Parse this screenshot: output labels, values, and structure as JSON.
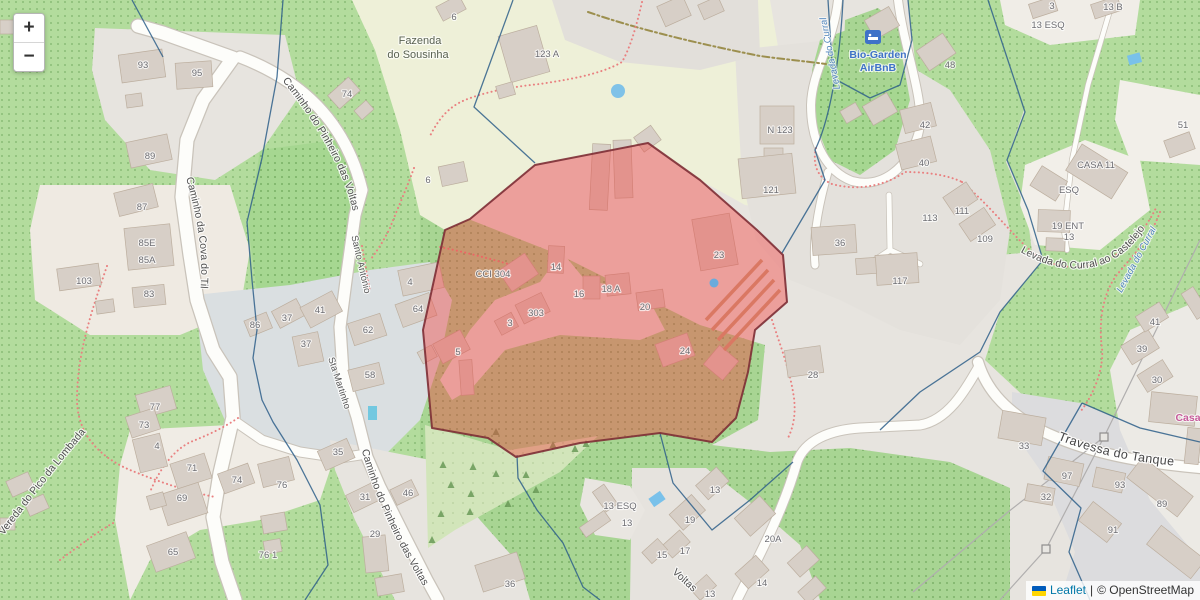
{
  "window": {
    "zoom_in": "+",
    "zoom_out": "−"
  },
  "attribution": {
    "flag": "ukraine-flag",
    "leaflet_link": "Leaflet",
    "separator": "|",
    "osm_text": "© OpenStreetMap"
  },
  "map": {
    "highlight": {
      "fill": "#f4413f",
      "fill_opacity": "0.42",
      "stroke": "#7d2d35"
    },
    "colors": {
      "forest_green": "#b3dc9d",
      "farmland": "#eef0d8",
      "residential": "#e4e1dc",
      "water": "#79c1ea",
      "boundary_blue": "#2e5f8a",
      "path_red": "#e98080"
    },
    "street_labels": [
      {
        "id": "p-pinheiro-top",
        "label": "Caminho do Pinheiro das Voltas",
        "cls": "street"
      },
      {
        "id": "p-cova",
        "label": "Caminho da Cova do Til",
        "cls": "street"
      },
      {
        "id": "p-vereda",
        "label": "Vereda do Pico da Lombada",
        "cls": "street"
      },
      {
        "id": "p-santo-antonio",
        "label": "Santo António",
        "cls": "street-small"
      },
      {
        "id": "p-sta-martinho",
        "label": "Sta Martinho",
        "cls": "street-small"
      },
      {
        "id": "p-pinheiro-bottom",
        "label": "Caminho do Pinheiro das Voltas",
        "cls": "street"
      },
      {
        "id": "p-voltas-frag",
        "label": "Voltas",
        "cls": "street"
      },
      {
        "id": "p-travessa",
        "label": "Travessa do Tanque",
        "cls": "street-big"
      },
      {
        "id": "p-levada-castelejo",
        "label": "Levada do Curral ao Castelejo",
        "cls": "street"
      },
      {
        "id": "p-levada-top",
        "label": "Levada do Curral",
        "cls": "water"
      },
      {
        "id": "p-levada-right",
        "label": "Levada do Curral",
        "cls": "water"
      }
    ],
    "place_labels": [
      {
        "label": "Fazenda",
        "x": 420,
        "y": 44,
        "cls": "place"
      },
      {
        "label": "do Sousinha",
        "x": 418,
        "y": 58,
        "cls": "place"
      },
      {
        "label": "Bio-Garden",
        "x": 878,
        "y": 58,
        "cls": "poi-lodging"
      },
      {
        "label": "AirBnB",
        "x": 878,
        "y": 71,
        "cls": "poi-lodging"
      },
      {
        "label": "Casa",
        "x": 1188,
        "y": 421,
        "cls": "poi-tourism"
      }
    ],
    "house_numbers": [
      {
        "t": "93",
        "x": 143,
        "y": 68
      },
      {
        "t": "95",
        "x": 197,
        "y": 76
      },
      {
        "t": "74",
        "x": 347,
        "y": 97
      },
      {
        "t": "89",
        "x": 150,
        "y": 159
      },
      {
        "t": "87",
        "x": 142,
        "y": 210
      },
      {
        "t": "85E",
        "x": 147,
        "y": 246
      },
      {
        "t": "85A",
        "x": 147,
        "y": 263
      },
      {
        "t": "103",
        "x": 84,
        "y": 284
      },
      {
        "t": "83",
        "x": 149,
        "y": 297
      },
      {
        "t": "86",
        "x": 255,
        "y": 328
      },
      {
        "t": "37",
        "x": 287,
        "y": 321
      },
      {
        "t": "41",
        "x": 320,
        "y": 313
      },
      {
        "t": "37",
        "x": 306,
        "y": 347
      },
      {
        "t": "62",
        "x": 368,
        "y": 333
      },
      {
        "t": "58",
        "x": 370,
        "y": 378
      },
      {
        "t": "64",
        "x": 418,
        "y": 312
      },
      {
        "t": "4",
        "x": 410,
        "y": 285
      },
      {
        "t": "6",
        "x": 454,
        "y": 20
      },
      {
        "t": "123 A",
        "x": 547,
        "y": 57
      },
      {
        "t": "6",
        "x": 428,
        "y": 183
      },
      {
        "t": "N 123",
        "x": 780,
        "y": 133
      },
      {
        "t": "121",
        "x": 771,
        "y": 193
      },
      {
        "t": "48",
        "x": 950,
        "y": 68
      },
      {
        "t": "42",
        "x": 925,
        "y": 128
      },
      {
        "t": "40",
        "x": 924,
        "y": 166
      },
      {
        "t": "36",
        "x": 840,
        "y": 246
      },
      {
        "t": "113",
        "x": 930,
        "y": 221
      },
      {
        "t": "111",
        "x": 962,
        "y": 214
      },
      {
        "t": "109",
        "x": 985,
        "y": 242
      },
      {
        "t": "117",
        "x": 900,
        "y": 284
      },
      {
        "t": "28",
        "x": 813,
        "y": 378
      },
      {
        "t": "3",
        "x": 1052,
        "y": 9
      },
      {
        "t": "13 B",
        "x": 1113,
        "y": 10
      },
      {
        "t": "13 ESQ",
        "x": 1048,
        "y": 28
      },
      {
        "t": "51",
        "x": 1183,
        "y": 128
      },
      {
        "t": "CASA 11",
        "x": 1096,
        "y": 168
      },
      {
        "t": "ESQ",
        "x": 1069,
        "y": 193
      },
      {
        "t": "19 ENT",
        "x": 1068,
        "y": 229
      },
      {
        "t": "13",
        "x": 1069,
        "y": 240
      },
      {
        "t": "41",
        "x": 1155,
        "y": 325
      },
      {
        "t": "39",
        "x": 1142,
        "y": 352
      },
      {
        "t": "30",
        "x": 1157,
        "y": 383
      },
      {
        "t": "33",
        "x": 1024,
        "y": 449
      },
      {
        "t": "97",
        "x": 1067,
        "y": 479
      },
      {
        "t": "93",
        "x": 1120,
        "y": 488
      },
      {
        "t": "89",
        "x": 1162,
        "y": 507
      },
      {
        "t": "91",
        "x": 1113,
        "y": 533
      },
      {
        "t": "32",
        "x": 1046,
        "y": 500
      },
      {
        "t": "77",
        "x": 155,
        "y": 410
      },
      {
        "t": "73",
        "x": 144,
        "y": 428
      },
      {
        "t": "4",
        "x": 157,
        "y": 449
      },
      {
        "t": "71",
        "x": 192,
        "y": 471
      },
      {
        "t": "69",
        "x": 182,
        "y": 501
      },
      {
        "t": "65",
        "x": 173,
        "y": 555
      },
      {
        "t": "74",
        "x": 237,
        "y": 483
      },
      {
        "t": "76",
        "x": 282,
        "y": 488
      },
      {
        "t": "76 1",
        "x": 268,
        "y": 558
      },
      {
        "t": "35",
        "x": 338,
        "y": 455
      },
      {
        "t": "31",
        "x": 365,
        "y": 500
      },
      {
        "t": "46",
        "x": 408,
        "y": 496
      },
      {
        "t": "29",
        "x": 375,
        "y": 537
      },
      {
        "t": "36",
        "x": 510,
        "y": 587
      },
      {
        "t": "13 ESQ",
        "x": 620,
        "y": 509
      },
      {
        "t": "13",
        "x": 627,
        "y": 526
      },
      {
        "t": "13",
        "x": 715,
        "y": 493
      },
      {
        "t": "19",
        "x": 690,
        "y": 523
      },
      {
        "t": "17",
        "x": 685,
        "y": 554
      },
      {
        "t": "15",
        "x": 662,
        "y": 558
      },
      {
        "t": "20A",
        "x": 773,
        "y": 542
      },
      {
        "t": "14",
        "x": 762,
        "y": 586
      },
      {
        "t": "13",
        "x": 710,
        "y": 597
      },
      {
        "t": "CCI 304",
        "x": 493,
        "y": 277
      },
      {
        "t": "14",
        "x": 556,
        "y": 270
      },
      {
        "t": "16",
        "x": 579,
        "y": 297
      },
      {
        "t": "18 A",
        "x": 611,
        "y": 292
      },
      {
        "t": "20",
        "x": 645,
        "y": 310
      },
      {
        "t": "23",
        "x": 719,
        "y": 258
      },
      {
        "t": "303",
        "x": 536,
        "y": 316
      },
      {
        "t": "3",
        "x": 510,
        "y": 326
      },
      {
        "t": "5",
        "x": 458,
        "y": 355
      },
      {
        "t": "24",
        "x": 685,
        "y": 354
      }
    ]
  }
}
